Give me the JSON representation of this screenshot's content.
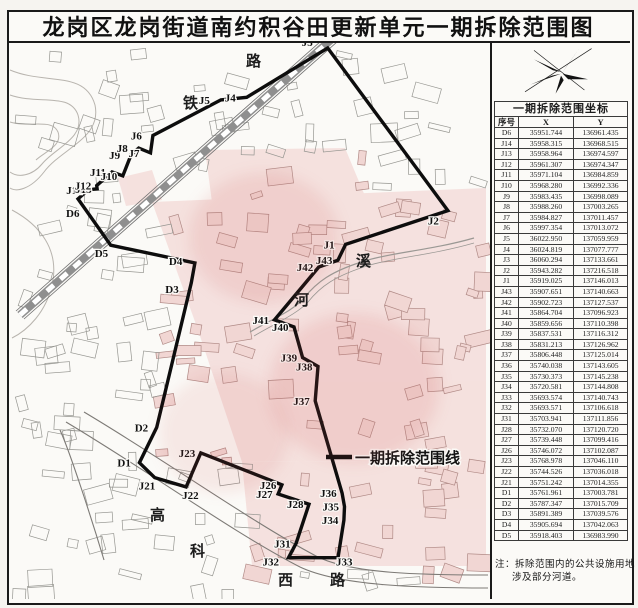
{
  "title": "龙岗区龙岗街道南约积谷田更新单元一期拆除范围图",
  "panel": {
    "compass_icon": "north-arrow",
    "table_title": "一期拆除范围坐标",
    "columns": [
      "序号",
      "X",
      "Y"
    ],
    "rows": [
      {
        "id": "D6",
        "x": "35951.744",
        "y": "136961.435"
      },
      {
        "id": "J14",
        "x": "35958.315",
        "y": "136968.515"
      },
      {
        "id": "J13",
        "x": "35958.964",
        "y": "136974.597"
      },
      {
        "id": "J12",
        "x": "35961.307",
        "y": "136974.347"
      },
      {
        "id": "J11",
        "x": "35971.104",
        "y": "136984.859"
      },
      {
        "id": "J10",
        "x": "35968.280",
        "y": "136992.336"
      },
      {
        "id": "J9",
        "x": "35983.435",
        "y": "136998.089"
      },
      {
        "id": "J8",
        "x": "35988.260",
        "y": "137003.265"
      },
      {
        "id": "J7",
        "x": "35984.827",
        "y": "137011.457"
      },
      {
        "id": "J6",
        "x": "35997.354",
        "y": "137013.072"
      },
      {
        "id": "J5",
        "x": "36022.950",
        "y": "137059.959"
      },
      {
        "id": "J4",
        "x": "36024.819",
        "y": "137077.777"
      },
      {
        "id": "J3",
        "x": "36060.294",
        "y": "137133.661"
      },
      {
        "id": "J2",
        "x": "35943.282",
        "y": "137216.518"
      },
      {
        "id": "J1",
        "x": "35919.025",
        "y": "137146.013"
      },
      {
        "id": "J43",
        "x": "35907.651",
        "y": "137140.663"
      },
      {
        "id": "J42",
        "x": "35902.723",
        "y": "137127.537"
      },
      {
        "id": "J41",
        "x": "35864.704",
        "y": "137096.923"
      },
      {
        "id": "J40",
        "x": "35859.656",
        "y": "137110.398"
      },
      {
        "id": "J39",
        "x": "35837.531",
        "y": "137116.312"
      },
      {
        "id": "J38",
        "x": "35831.213",
        "y": "137126.962"
      },
      {
        "id": "J37",
        "x": "35806.448",
        "y": "137125.014"
      },
      {
        "id": "J36",
        "x": "35740.038",
        "y": "137143.605"
      },
      {
        "id": "J35",
        "x": "35730.373",
        "y": "137145.238"
      },
      {
        "id": "J34",
        "x": "35720.581",
        "y": "137144.808"
      },
      {
        "id": "J33",
        "x": "35693.574",
        "y": "137140.743"
      },
      {
        "id": "J32",
        "x": "35693.571",
        "y": "137106.618"
      },
      {
        "id": "J31",
        "x": "35703.941",
        "y": "137111.856"
      },
      {
        "id": "J28",
        "x": "35732.070",
        "y": "137120.720"
      },
      {
        "id": "J27",
        "x": "35739.448",
        "y": "137099.416"
      },
      {
        "id": "J26",
        "x": "35746.072",
        "y": "137102.087"
      },
      {
        "id": "J23",
        "x": "35768.978",
        "y": "137046.110"
      },
      {
        "id": "J22",
        "x": "35744.526",
        "y": "137036.018"
      },
      {
        "id": "J21",
        "x": "35751.242",
        "y": "137014.355"
      },
      {
        "id": "D1",
        "x": "35761.961",
        "y": "137003.781"
      },
      {
        "id": "D2",
        "x": "35787.347",
        "y": "137015.709"
      },
      {
        "id": "D3",
        "x": "35891.389",
        "y": "137039.576"
      },
      {
        "id": "D4",
        "x": "35905.694",
        "y": "137042.063"
      },
      {
        "id": "D5",
        "x": "35918.403",
        "y": "136983.990"
      }
    ],
    "note": "注：拆除范围内的公共设施用地涉及部分河道。"
  },
  "map": {
    "legend": {
      "label": "一期拆除范围线"
    },
    "labels": {
      "railway": [
        "铁",
        "路"
      ],
      "road": [
        "高",
        "科",
        "西",
        "路"
      ],
      "river": [
        "河",
        "溪"
      ]
    }
  }
}
